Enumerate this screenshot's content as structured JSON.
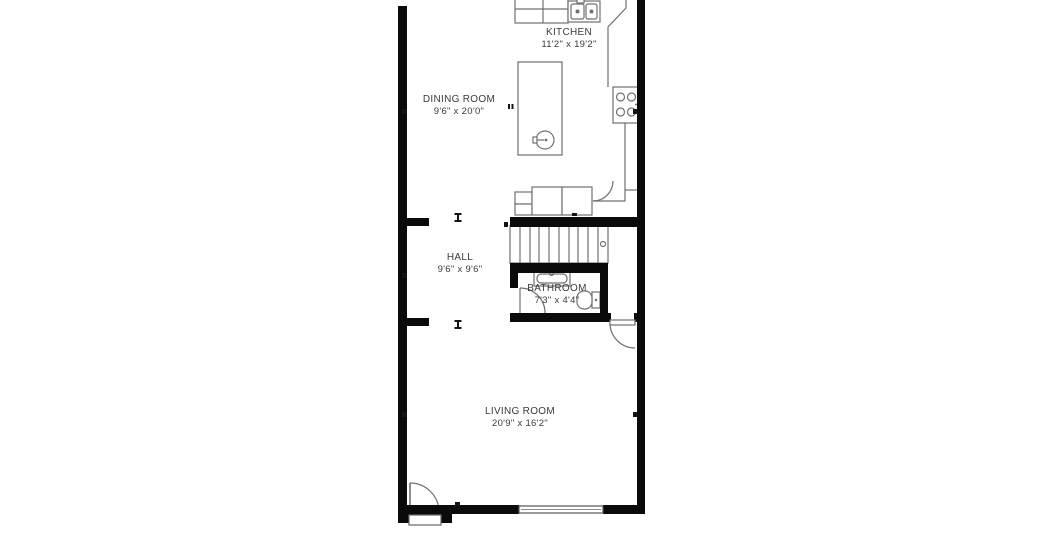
{
  "title": "Floor plan",
  "colors": {
    "background": "#ffffff",
    "wall": "#0a0a0a",
    "fixture_line": "#707070",
    "label_text": "#3a3a3a"
  },
  "rooms": [
    {
      "id": "kitchen",
      "label": "KITCHEN",
      "dimensions": "11'2\" x 19'2\""
    },
    {
      "id": "dining",
      "label": "DINING ROOM",
      "dimensions": "9'6\" x 20'0\""
    },
    {
      "id": "hall",
      "label": "HALL",
      "dimensions": "9'6\" x 9'6\""
    },
    {
      "id": "bathroom",
      "label": "BATHROOM",
      "dimensions": "7'3\" x 4'4\""
    },
    {
      "id": "living",
      "label": "LIVING ROOM",
      "dimensions": "20'9\" x 16'2\""
    }
  ],
  "icons": {
    "stove": "4-burner-cooktop",
    "kitchen_sink": "double-basin-sink",
    "island_sink": "round-prep-sink",
    "bathroom_sink": "vanity-sink",
    "toilet": "toilet",
    "stairs": "staircase",
    "window": "window",
    "doors": "door-swing-arc"
  }
}
